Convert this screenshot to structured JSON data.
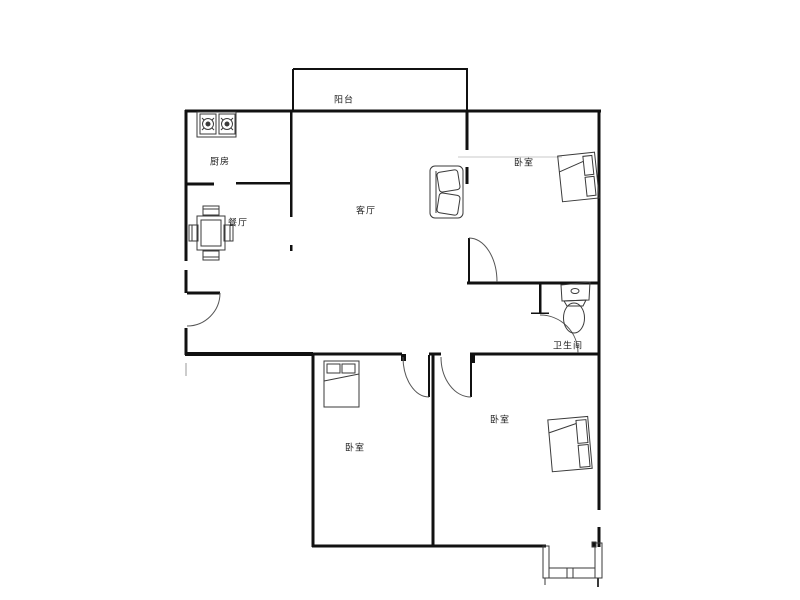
{
  "floorplan": {
    "rooms": {
      "balcony": {
        "label": "阳台"
      },
      "kitchen": {
        "label": "厨房"
      },
      "dining": {
        "label": "餐厅"
      },
      "living": {
        "label": "客厅"
      },
      "bedroom_top": {
        "label": "卧室"
      },
      "bathroom": {
        "label": "卫生间"
      },
      "bedroom_middle": {
        "label": "卧室"
      },
      "bedroom_right": {
        "label": "卧室"
      }
    },
    "furniture": [
      "stove",
      "dining-table",
      "sofa",
      "bed",
      "toilet",
      "bay-window"
    ],
    "colors": {
      "wall": "#111111",
      "furniture_line": "#3a3a3a",
      "door_arc": "#555555",
      "faint_line": "#c8c8c8",
      "background": "#ffffff",
      "text": "#222222"
    }
  }
}
